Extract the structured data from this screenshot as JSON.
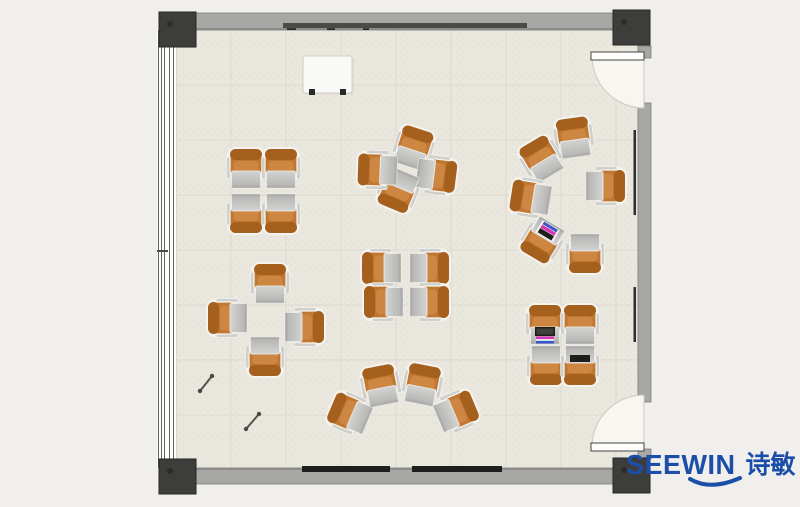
{
  "logo": {
    "brand": "SEEWIN",
    "chinese": "诗敏",
    "color": "#1b4ea9"
  },
  "palette": {
    "page": "#f0efed",
    "floor": "#eae7de",
    "floor_speckle": "#e0ddd4",
    "tile_line": "#dedad1",
    "floor_edge": "#c9c6bd",
    "wall": "#a7a7a5",
    "wall_inner": "#8a8a86",
    "wall_edge": "#7e7e7c",
    "column": "#3d3d3b",
    "column_edge": "#262624",
    "column_dot": "#2b2b29",
    "window_bg": "#fcfcfa",
    "window_line": "#63635f",
    "rail_dark": "#4a4a46",
    "board_rail": "#1e1e1c",
    "wall_mark": "#2e2e2c",
    "door_leaf": "#fdfdfb",
    "door_edge": "#45453f",
    "arc_fill": "#f7f6f1",
    "arc_line": "#ccc9c1",
    "chair": "#c1772f",
    "chair_back": "#a5601e",
    "chair_light": "#cd8742",
    "halo": "#f4f3ef",
    "arm": "#cfcfcb",
    "desk_hi": "#d3d3d1",
    "desk_lo": "#b2b2b0",
    "desk_edge": "#f0efec",
    "desk_front": "#a6a6a4",
    "item_black": "#1d1d1b",
    "item_pink": "#d936b4",
    "item_blue": "#3a55c6",
    "item_white": "#f2f2f0",
    "whiteboard": "#f9f9f7",
    "whiteboard_edge": "#cfcdc6",
    "whiteboard_shadow": "#dddbd4",
    "stick": "#54544e",
    "stick_dot": "#4a4a44"
  },
  "room": {
    "x": 176,
    "y": 30,
    "w": 462,
    "h": 438,
    "tile": 55
  },
  "walls": {
    "top": {
      "x": 176,
      "y": 13,
      "w": 462,
      "h": 17
    },
    "bottom": {
      "x": 176,
      "y": 468,
      "w": 462,
      "h": 16
    },
    "right": {
      "x": 638,
      "w": 13,
      "segments": [
        {
          "y": 46,
          "h": 12
        },
        {
          "y": 103,
          "h": 299
        },
        {
          "y": 449,
          "h": 10
        }
      ]
    }
  },
  "window": {
    "x": 157,
    "y": 30,
    "w": 19,
    "h": 438,
    "lines": [
      158.5,
      161.5,
      164.5,
      169.5,
      173.5
    ],
    "tick_y": 250
  },
  "columns": {
    "w": 37,
    "h": 35,
    "at": [
      {
        "x": 159,
        "y": 12
      },
      {
        "x": 613,
        "y": 10
      },
      {
        "x": 159,
        "y": 459
      },
      {
        "x": 613,
        "y": 458
      }
    ]
  },
  "doors": [
    {
      "start": [
        592,
        56
      ],
      "end": [
        644,
        108
      ],
      "r": 52,
      "sweep": 0,
      "hinge": [
        644,
        56
      ],
      "leaf": [
        591,
        52,
        53,
        8
      ]
    },
    {
      "start": [
        592,
        447
      ],
      "end": [
        644,
        395
      ],
      "r": 52,
      "sweep": 1,
      "hinge": [
        644,
        447
      ],
      "leaf": [
        591,
        443,
        53,
        8
      ]
    }
  ],
  "board_rail_top": {
    "x": 283,
    "y": 23,
    "w": 244,
    "h": 5,
    "marks": [
      [
        287,
        9
      ],
      [
        327,
        8
      ],
      [
        363,
        6
      ]
    ],
    "mark_y": 28.3
  },
  "board_rails_bottom": {
    "y": 466,
    "h": 6,
    "at": [
      {
        "x": 302,
        "w": 88
      },
      {
        "x": 412,
        "w": 90
      }
    ]
  },
  "wall_marks": [
    {
      "x": 633.5,
      "y": 130,
      "w": 2.5,
      "h": 85
    },
    {
      "x": 633.5,
      "y": 287,
      "w": 2.5,
      "h": 55
    }
  ],
  "whiteboard": {
    "x": 303,
    "y": 56,
    "w": 49,
    "h": 37,
    "feet": [
      [
        309,
        89
      ],
      [
        340,
        89
      ]
    ],
    "foot": 6
  },
  "sticks": [
    [
      200,
      391,
      212,
      376
    ],
    [
      246,
      429,
      259,
      414
    ]
  ],
  "units": [
    {
      "cluster": "top-left-quad",
      "x": 246,
      "y": 170,
      "r": 0
    },
    {
      "cluster": "top-left-quad",
      "x": 281,
      "y": 170,
      "r": 0
    },
    {
      "cluster": "top-left-quad",
      "x": 246,
      "y": 212,
      "r": 180
    },
    {
      "cluster": "top-left-quad",
      "x": 281,
      "y": 212,
      "r": 180
    },
    {
      "cluster": "center-pinwheel",
      "x": 413,
      "y": 149,
      "r": 18
    },
    {
      "cluster": "center-pinwheel",
      "x": 435,
      "y": 175,
      "r": 97
    },
    {
      "cluster": "center-pinwheel",
      "x": 399,
      "y": 189,
      "r": 203
    },
    {
      "cluster": "center-pinwheel",
      "x": 379,
      "y": 170,
      "r": 272
    },
    {
      "cluster": "right-circle",
      "x": 574,
      "y": 139,
      "r": 352
    },
    {
      "cluster": "right-circle",
      "x": 542,
      "y": 160,
      "r": 329
    },
    {
      "cluster": "right-circle",
      "x": 604,
      "y": 186,
      "r": 90
    },
    {
      "cluster": "right-circle",
      "x": 532,
      "y": 198,
      "r": 279
    },
    {
      "cluster": "right-circle",
      "x": 543,
      "y": 239,
      "r": 211,
      "item": "laptop_color"
    },
    {
      "cluster": "right-circle",
      "x": 585,
      "y": 252,
      "r": 180
    },
    {
      "cluster": "left-cross",
      "x": 270,
      "y": 285,
      "r": 0
    },
    {
      "cluster": "left-cross",
      "x": 229,
      "y": 318,
      "r": 270
    },
    {
      "cluster": "left-cross",
      "x": 303,
      "y": 327,
      "r": 90
    },
    {
      "cluster": "left-cross",
      "x": 265,
      "y": 355,
      "r": 180
    },
    {
      "cluster": "mid-face-pairs",
      "x": 383,
      "y": 268,
      "r": 270
    },
    {
      "cluster": "mid-face-pairs",
      "x": 428,
      "y": 268,
      "r": 90
    },
    {
      "cluster": "mid-face-pairs",
      "x": 385,
      "y": 302,
      "r": 270
    },
    {
      "cluster": "mid-face-pairs",
      "x": 428,
      "y": 302,
      "r": 90
    },
    {
      "cluster": "bottom-fan",
      "x": 351,
      "y": 414,
      "r": 293
    },
    {
      "cluster": "bottom-fan",
      "x": 381,
      "y": 387,
      "r": 349
    },
    {
      "cluster": "bottom-fan",
      "x": 422,
      "y": 386,
      "r": 11
    },
    {
      "cluster": "bottom-fan",
      "x": 455,
      "y": 412,
      "r": 67
    },
    {
      "cluster": "bottom-right-quad",
      "x": 545,
      "y": 326,
      "r": 0,
      "item": "laptop_papers"
    },
    {
      "cluster": "bottom-right-quad",
      "x": 580,
      "y": 326,
      "r": 0
    },
    {
      "cluster": "bottom-right-quad",
      "x": 546,
      "y": 364,
      "r": 180
    },
    {
      "cluster": "bottom-right-quad",
      "x": 580,
      "y": 364,
      "r": 180,
      "item": "tablet"
    }
  ]
}
